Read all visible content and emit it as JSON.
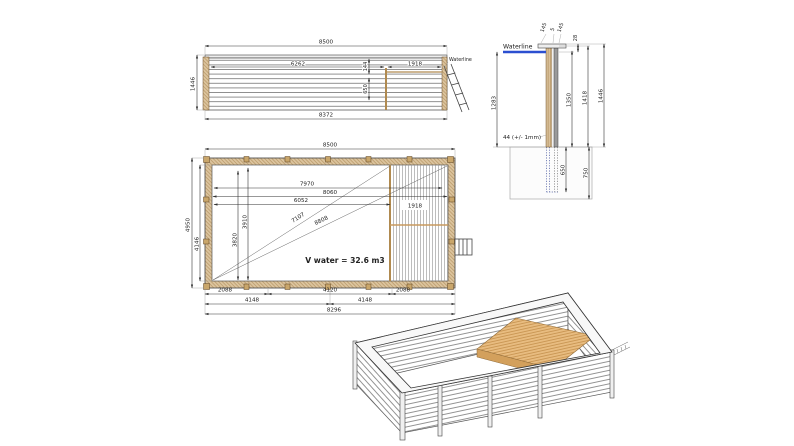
{
  "drawing_title": "wooden-pool-technical-drawing",
  "colors": {
    "wood_tan": "#dcc49e",
    "wood_line": "#a8854f",
    "deck_tan": "#e8bc80",
    "waterline_blue": "#2b4fd0",
    "line_dark": "#333333"
  },
  "side_view": {
    "dim_overall_width": "8500",
    "dim_wall_length": "8372",
    "dim_height": "1446",
    "dim_pool_section": "6262",
    "dim_deck_section": "1918",
    "dim_rim_offset": "144",
    "dim_deck_drop": "650",
    "waterline_label": "Waterline"
  },
  "section_view": {
    "waterline_label": "Waterline",
    "dim_cap_left": "145",
    "dim_cap_gap": "5",
    "dim_cap_right": "145",
    "dim_top_offset": "28",
    "dim_water_depth": "1283",
    "dim_inner_height": "1350",
    "dim_wall_height": "1418",
    "dim_total_height": "1446",
    "dim_embed_depth": "650",
    "dim_foundation_depth": "750",
    "tolerance_note": "44 (+/- 1mm)"
  },
  "plan_view": {
    "dim_overall_width": "8500",
    "dim_overall_height": "4950",
    "dim_inner_height": "4146",
    "dim_inner_7970": "7970",
    "dim_inner_8060": "8060",
    "dim_inner_6052": "6052",
    "dim_diag_7107": "7107",
    "dim_diag_8808": "8808",
    "dim_vert_3910": "3910",
    "dim_vert_3820": "3820",
    "dim_deck_width": "1918",
    "volume_note": "V water = 32.6 m3",
    "bottom_row1": [
      "2088",
      "4120",
      "2088"
    ],
    "bottom_row2": [
      "4148",
      "4148"
    ],
    "bottom_total": "8296"
  }
}
